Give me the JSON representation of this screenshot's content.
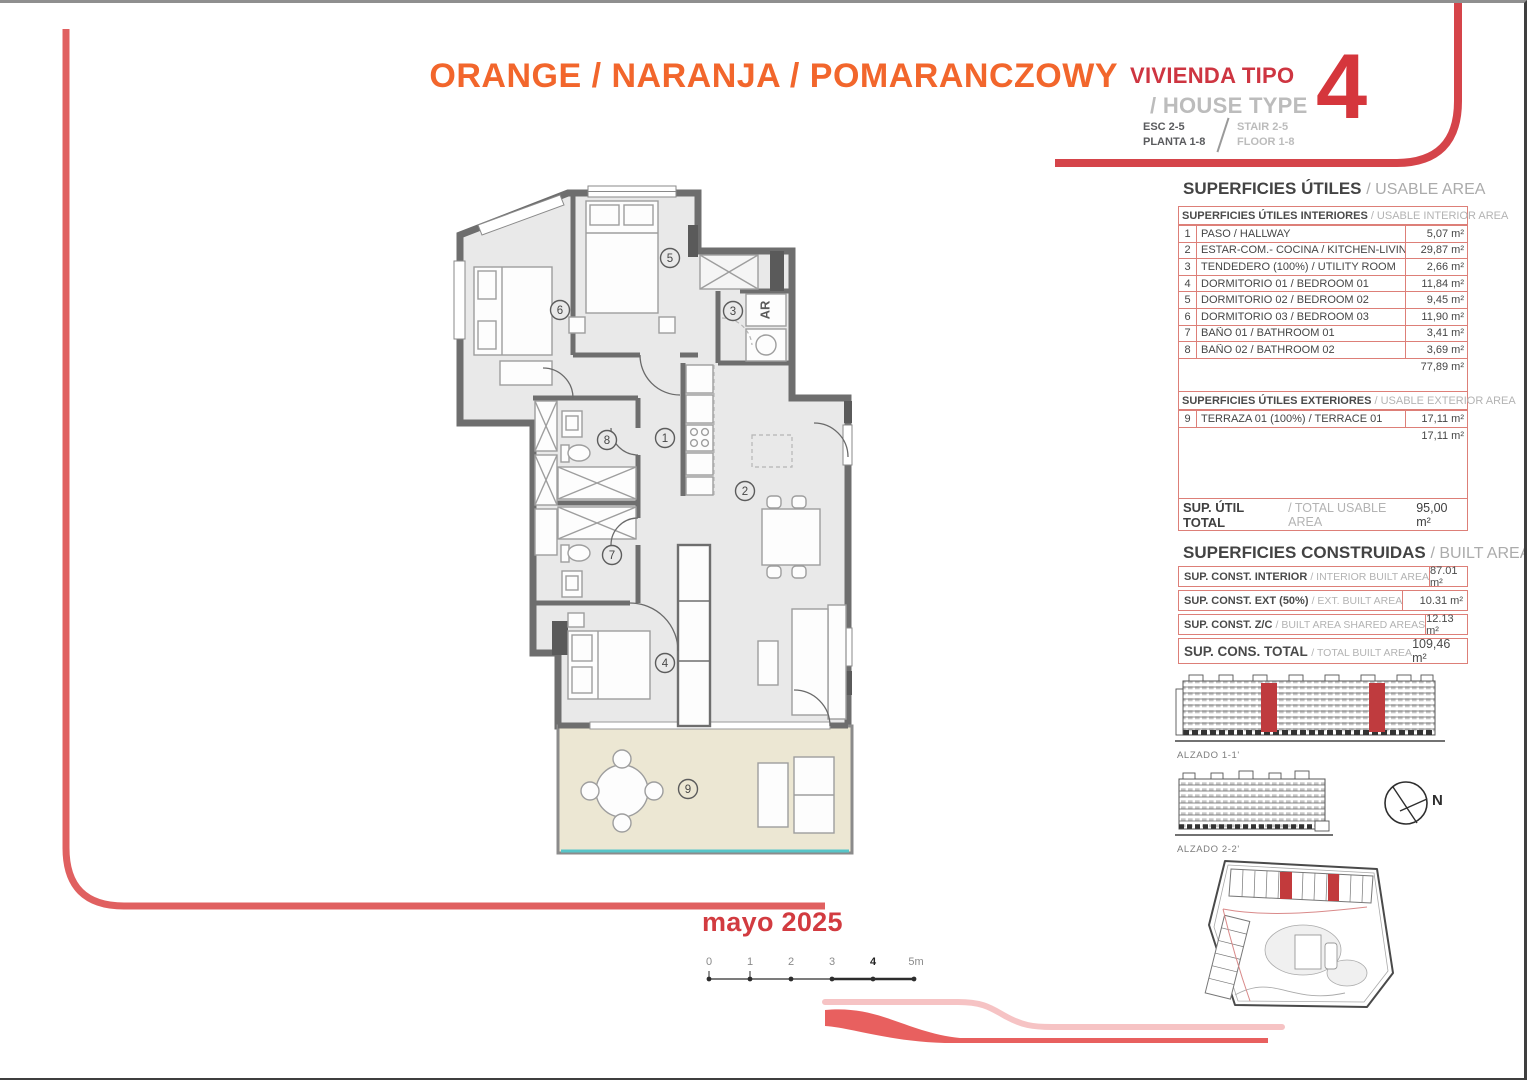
{
  "header": {
    "color_title": "ORANGE / NARANJA / POMARANCZOWY",
    "type_label_es": "VIVIENDA TIPO",
    "type_label_en": "/ HOUSE TYPE",
    "type_number": "4",
    "stair_es": "ESC 2-5",
    "floor_es": "PLANTA 1-8",
    "stair_en": "STAIR 2-5",
    "floor_en": "FLOOR 1-8"
  },
  "usable": {
    "title_es": "SUPERFICIES ÚTILES",
    "title_en": "/ USABLE AREA",
    "interior_header_es": "SUPERFICIES ÚTILES INTERIORES",
    "interior_header_en": "/ USABLE INTERIOR AREA",
    "interior_rows": [
      {
        "num": "1",
        "label": "PASO / HALLWAY",
        "value": "5,07 m²"
      },
      {
        "num": "2",
        "label": "ESTAR-COM.- COCINA / KITCHEN-LIVING",
        "value": "29,87 m²"
      },
      {
        "num": "3",
        "label": "TENDEDERO (100%) / UTILITY ROOM",
        "value": "2,66 m²"
      },
      {
        "num": "4",
        "label": "DORMITORIO 01 / BEDROOM 01",
        "value": "11,84 m²"
      },
      {
        "num": "5",
        "label": "DORMITORIO 02 / BEDROOM 02",
        "value": "9,45 m²"
      },
      {
        "num": "6",
        "label": "DORMITORIO 03 / BEDROOM 03",
        "value": "11,90 m²"
      },
      {
        "num": "7",
        "label": "BAÑO 01 / BATHROOM 01",
        "value": "3,41 m²"
      },
      {
        "num": "8",
        "label": "BAÑO 02 / BATHROOM 02",
        "value": "3,69 m²"
      }
    ],
    "interior_subtotal": "77,89 m²",
    "exterior_header_es": "SUPERFICIES ÚTILES EXTERIORES",
    "exterior_header_en": "/ USABLE EXTERIOR AREA",
    "exterior_row": {
      "num": "9",
      "label": "TERRAZA 01 (100%) / TERRACE 01",
      "value": "17,11 m²"
    },
    "exterior_subtotal": "17,11 m²",
    "total_label_es": "SUP. ÚTIL TOTAL",
    "total_label_en": "/ TOTAL USABLE AREA",
    "total_value": "95,00 m²"
  },
  "built": {
    "title_es": "SUPERFICIES CONSTRUIDAS",
    "title_en": "/ BUILT AREA",
    "rows": [
      {
        "label_es": "SUP. CONST. INTERIOR",
        "label_en": "/ INTERIOR BUILT AREA",
        "value": "87.01 m²"
      },
      {
        "label_es": "SUP. CONST. EXT (50%)",
        "label_en": "/ EXT. BUILT AREA",
        "value": "10.31 m²"
      },
      {
        "label_es": "SUP. CONST. Z/C",
        "label_en": "/ BUILT AREA SHARED AREAS",
        "value": "12.13 m²"
      }
    ],
    "total": {
      "label_es": "SUP. CONS. TOTAL",
      "label_en": "/ TOTAL BUILT AREA",
      "value": "109,46 m²"
    }
  },
  "plan": {
    "rooms": [
      "1",
      "2",
      "3",
      "4",
      "5",
      "6",
      "7",
      "8",
      "9"
    ],
    "ar_label": "AR"
  },
  "elevations": {
    "alzado1": "ALZADO 1-1'",
    "alzado2": "ALZADO 2-2'",
    "compass_n": "N"
  },
  "footer": {
    "date": "mayo 2025",
    "scale_ticks": [
      "0",
      "1",
      "2",
      "3",
      "4",
      "5m"
    ]
  },
  "colors": {
    "orange": "#f2662c",
    "red": "#d5363c",
    "salmon_border": "#dd7f78",
    "frame_red": "#e06060",
    "ribbon_pink": "#f6c3c4",
    "terrace_beige": "#ece7d3",
    "glass_teal": "#57c5c8",
    "wall_gray": "#6e6e6e"
  }
}
